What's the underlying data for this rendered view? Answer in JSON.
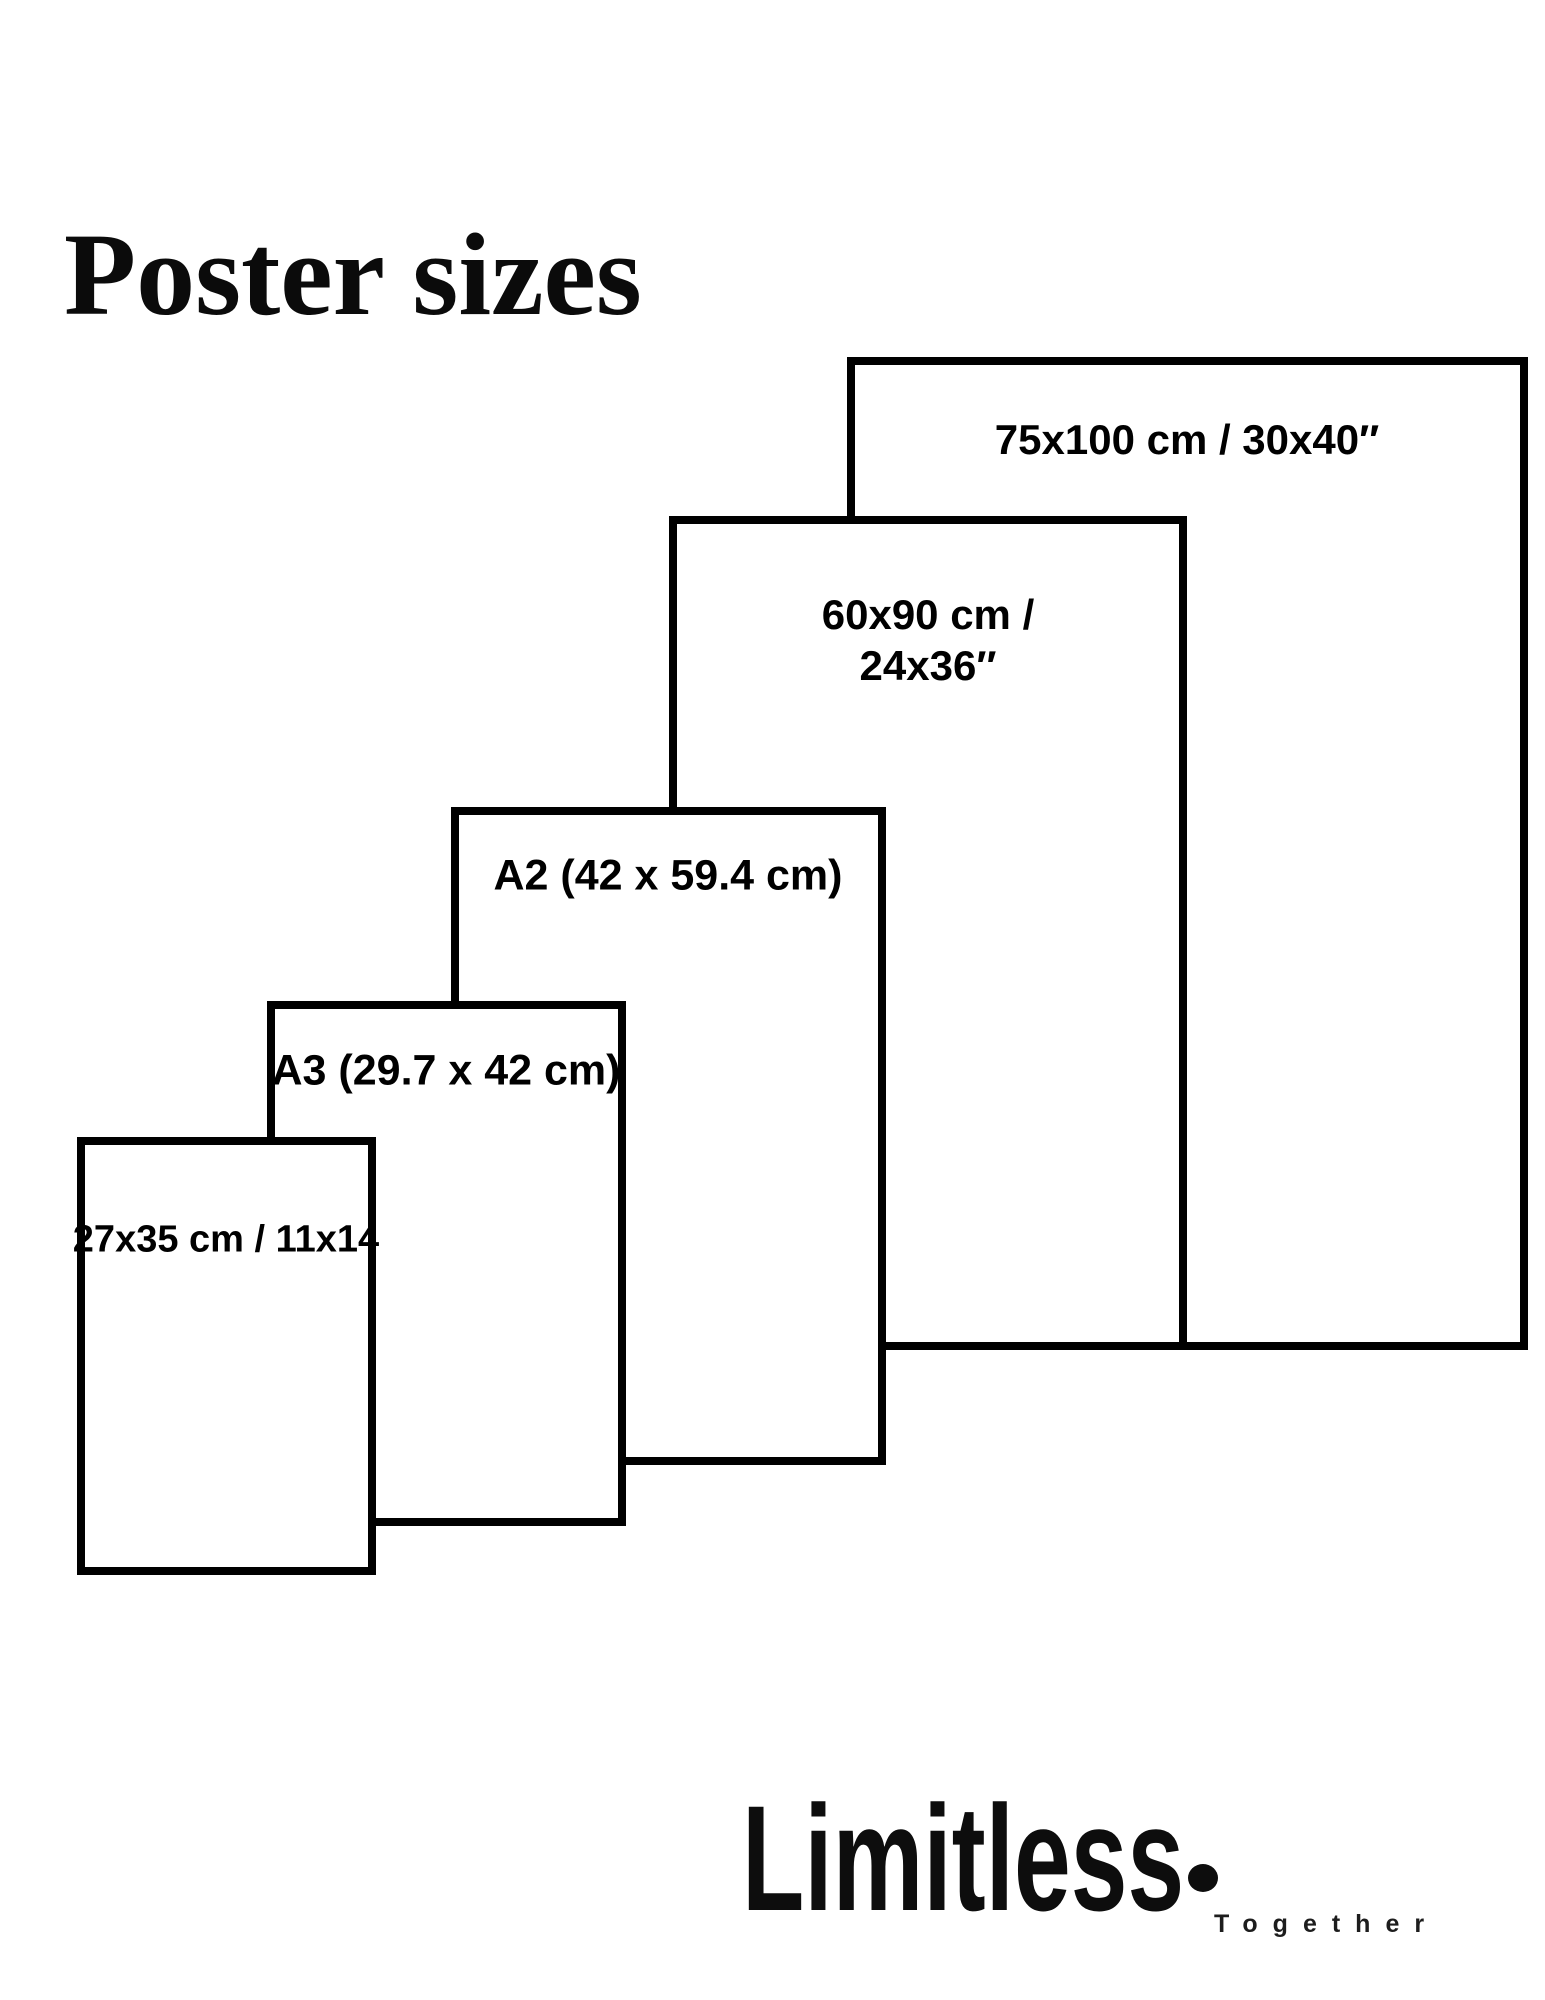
{
  "page": {
    "title": "Poster sizes"
  },
  "diagram": {
    "posters": [
      {
        "id": "75x100",
        "label": "75x100 cm / 30x40″"
      },
      {
        "id": "60x90",
        "label_line1": "60x90 cm /",
        "label_line2": "24x36″"
      },
      {
        "id": "a2",
        "label": "A2 (42 x 59.4 cm)"
      },
      {
        "id": "a3",
        "label": "A3 (29.7 x 42 cm)"
      },
      {
        "id": "27x35",
        "label": "27x35 cm / 11x14"
      }
    ]
  },
  "brand": {
    "name": "Limitless",
    "tagline": "Together"
  },
  "colors": {
    "background": "#ffffff",
    "line": "#000000",
    "text": "#000000"
  }
}
